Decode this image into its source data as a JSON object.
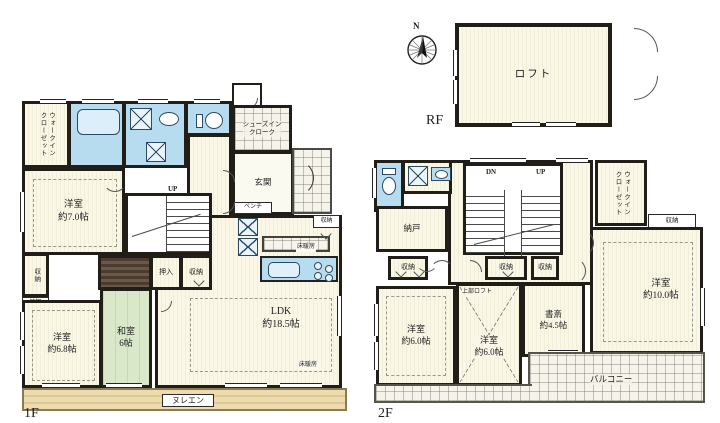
{
  "colors": {
    "wall": "#211e18",
    "room_fill": "#f7f4e2",
    "wet_fill": "#b7dcef",
    "tatami_fill": "#d9e8c8",
    "deck_fill": "#e7d5a3",
    "paper": "#ffffff"
  },
  "floor1": {
    "floor_label": "1F",
    "wic": "ウォークイン\nクローゼット",
    "shoes_cloak": "シューズイン\nクローク",
    "genkan": "玄関",
    "bench": "ベンチ",
    "up": "UP",
    "room7": "洋室\n約7.0帖",
    "room68": "洋室\n約6.8帖",
    "washitsu": "和室\n6帖",
    "ldk": "LDK\n約18.5帖",
    "oshiire": "押入",
    "shuno": "収納",
    "kamidana": "神棚",
    "floor_heating": "床暖房",
    "nureen": "ヌレエン"
  },
  "floor2": {
    "floor_label": "2F",
    "rf_label": "RF",
    "compass_n": "N",
    "loft": "ロフト",
    "nando": "納戸",
    "dn": "DN",
    "up": "UP",
    "wic": "ウォークイン\nクローゼット",
    "shuno": "収納",
    "room10": "洋室\n約10.0帖",
    "room6a": "洋室\n約6.0帖",
    "room6b": "洋室\n約6.0帖",
    "upper_loft": "上部ロフト",
    "study": "書斎\n約4.5帖",
    "balcony": "バルコニー"
  }
}
